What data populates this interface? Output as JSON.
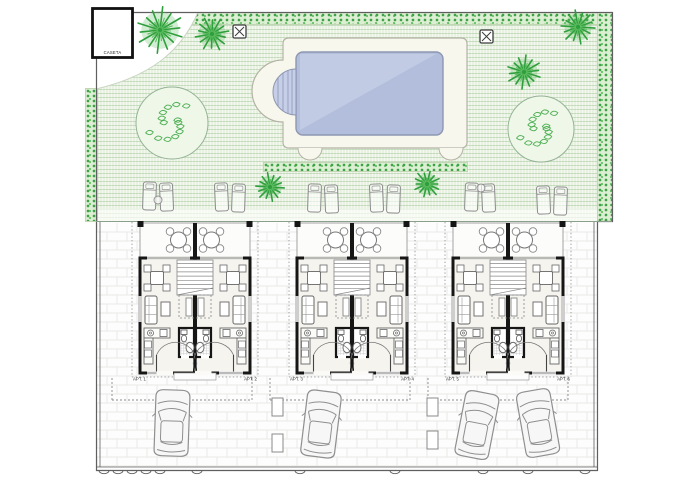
{
  "title": "Residential complex site plan - pool garden, three duplex blocks, parking court",
  "building": {
    "label": "CASETA"
  },
  "units": [
    "APT. 1",
    "APT. 2",
    "APT. 3",
    "APT. 4",
    "APT. 5",
    "APT. 6"
  ],
  "palette": {
    "lawn": "#e9f2e2",
    "hedgeDot": "#3fa24b",
    "hedgeBg": "#dcefd2",
    "deck": "#f8f7ee",
    "deckEdge": "#b3b3a5",
    "water": "#b2bedc",
    "waterLight": "#ccd4ea",
    "waterEdge": "#8d97b2",
    "steps": "#c6cfe7",
    "wall": "#161616",
    "thin": "#777777",
    "furn": "#666666",
    "floor": "#f6f4ef",
    "terrace": "#fcfcfa",
    "brick": "#e9e9e6",
    "boundary": "#5f5f5f",
    "divider": "#8aa08a",
    "dash": "#8a8a8a",
    "car": "#8f8f8f",
    "carFill": "#f7f7f7",
    "tree": "#2f9e3c",
    "treeLight": "#5fbd62",
    "bushEdge": "#94b294",
    "bushFill": "#eef7e8",
    "bushLine": "#4cae52",
    "lounger": "#8b8b8b",
    "label": "#333333"
  },
  "blocks": {
    "lefts": [
      140,
      297,
      453
    ],
    "width": 110
  },
  "pool": {
    "deck": [
      283,
      38,
      184,
      110
    ],
    "water": [
      296,
      52,
      147,
      83
    ],
    "lawnArcs": [
      310,
      451
    ]
  },
  "x_markers": [
    [
      233,
      25
    ],
    [
      480,
      30
    ]
  ],
  "trees": [
    [
      160,
      30,
      26
    ],
    [
      212,
      34,
      19
    ],
    [
      578,
      27,
      19
    ],
    [
      524,
      72,
      19
    ],
    [
      270,
      187,
      16
    ],
    [
      427,
      184,
      15
    ]
  ],
  "bushes": [
    [
      172,
      123,
      36
    ],
    [
      541,
      129,
      33
    ]
  ],
  "lounger_pairs": [
    {
      "x": 143,
      "y": 182,
      "table": [
        15,
        18
      ]
    },
    {
      "x": 215,
      "y": 183,
      "table": null
    },
    {
      "x": 308,
      "y": 184,
      "table": null
    },
    {
      "x": 370,
      "y": 184,
      "table": null
    },
    {
      "x": 465,
      "y": 183,
      "table": [
        16,
        5
      ]
    },
    {
      "x": 537,
      "y": 186,
      "table": null
    }
  ],
  "cars": [
    [
      172,
      423,
      2
    ],
    [
      321,
      424,
      7
    ],
    [
      477,
      425,
      11
    ],
    [
      538,
      423,
      -10
    ]
  ],
  "planters": [
    [
      272,
      398
    ],
    [
      272,
      434
    ],
    [
      427,
      398
    ],
    [
      427,
      431
    ]
  ],
  "bays": [
    [
      112,
      252
    ],
    [
      270,
      410
    ],
    [
      428,
      568
    ]
  ],
  "fence_ticks": [
    104,
    118,
    132,
    146,
    160,
    197,
    300,
    395,
    483,
    528,
    585
  ]
}
